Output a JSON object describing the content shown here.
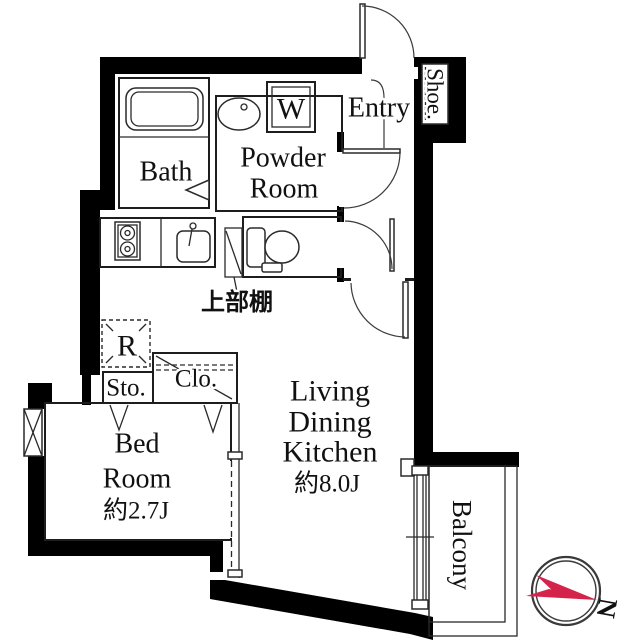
{
  "floorplan": {
    "labels": {
      "bath": "Bath",
      "powder_line1": "Powder",
      "powder_line2": "Room",
      "washer": "W",
      "entry": "Entry",
      "shoe": "Shoe.",
      "upper_shelf": "上部棚",
      "refrigerator": "R",
      "storage": "Sto.",
      "closet": "Clo.",
      "bed_line1": "Bed",
      "bed_line2": "Room",
      "bed_area": "約2.7J",
      "ldk_line1": "Living",
      "ldk_line2": "Dining",
      "ldk_line3": "Kitchen",
      "ldk_area": "約8.0J",
      "balcony": "Balcony",
      "compass_north": "N"
    },
    "colors": {
      "wall": "#000000",
      "compass_red": "#d4244c"
    }
  }
}
